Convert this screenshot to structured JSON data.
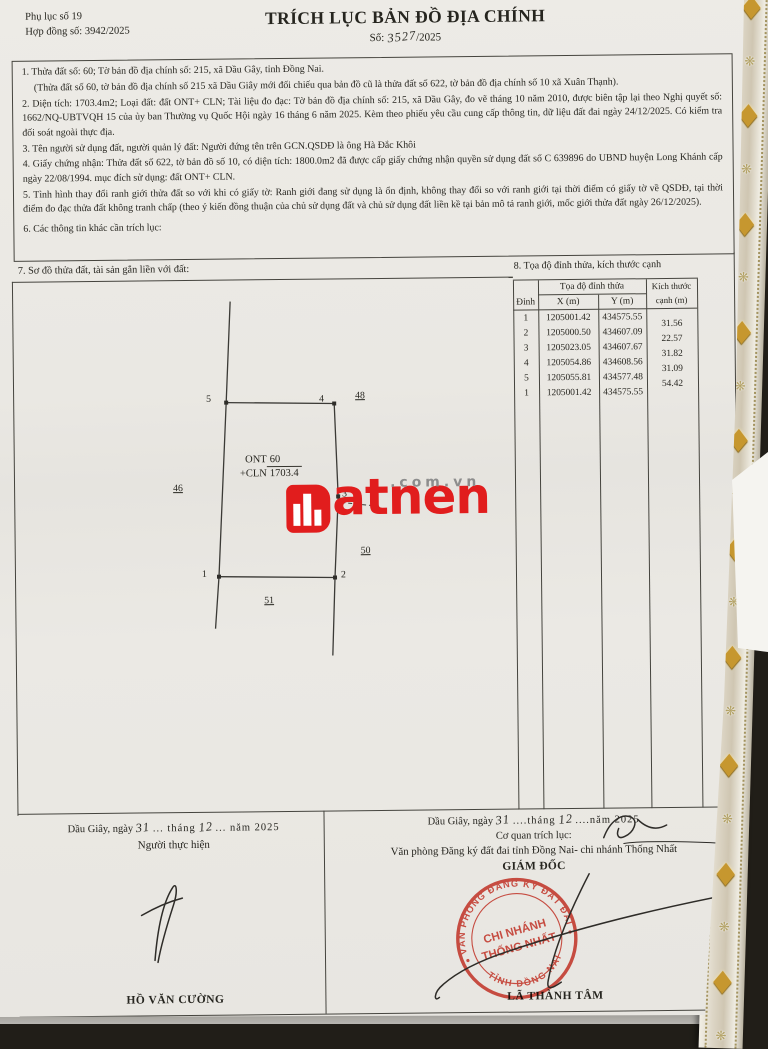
{
  "doc": {
    "appendix": "Phụ lục số 19",
    "contract_no": "Hợp đồng số: 3942/2025",
    "title": "TRÍCH LỤC BẢN ĐỒ ĐỊA CHÍNH",
    "number_prefix": "Số:",
    "number_handwritten": "3527",
    "number_suffix": "/2025"
  },
  "items": {
    "item1": "1. Thửa đất số: 60; Tờ bản đồ địa chính số: 215, xã Dầu Gây, tỉnh Đồng Nai.",
    "item1_note": "(Thửa đất số 60, tờ bản đồ địa chính số 215 xã Dầu Giây mới đối chiếu qua bản đồ cũ là thửa đất số 622, tờ bản đồ địa chính số 10 xã Xuân Thạnh).",
    "item2": "2. Diện tích: 1703.4m2; Loại đất: đất ONT+ CLN; Tài liệu đo đạc: Tờ bản đồ địa chính số: 215, xã Dầu Gây, đo vẽ tháng 10 năm 2010, được biên tập lại theo Nghị quyết số: 1662/NQ-UBTVQH 15 của ủy ban Thường vụ Quốc Hội ngày 16 tháng 6 năm 2025. Kèm theo phiếu yêu cầu cung cấp thông tin, dữ liệu đất đai ngày 24/12/2025. Có kiểm tra đối soát ngoài thực địa.",
    "item3": "3. Tên người sử dụng đất, người quản lý đất: Người đứng tên trên GCN.QSDĐ là ông Hà Đắc Khôi",
    "item4": "4. Giấy chứng nhận: Thửa đất số 622, tờ bản đồ số 10, có diện tích: 1800.0m2 đã được cấp giấy chứng nhận quyền sử dụng đất số C 639896 do UBND huyện Long Khánh cấp ngày 22/08/1994. mục đích sử dụng: đất ONT+ CLN.",
    "item5": "5. Tình hình thay đổi ranh giới thửa đất so với khi có giấy tờ: Ranh giới đang sử dụng là ổn định, không thay đổi so với ranh giới tại thời điểm có giấy tờ về QSDĐ, tại thời điểm đo đạc thửa đất không tranh chấp (theo ý kiến đồng thuận của chủ sử dụng đất và chủ sử dụng đất liền kề tại bản mô tả ranh giới, mốc giới thửa đất ngày 26/12/2025).",
    "item6": "6. Các thông tin khác cần trích lục:"
  },
  "section7": {
    "heading": "7. Sơ đồ thửa đất, tài sản gắn liền với đất:",
    "sketch": {
      "land_use_code1": "ONT",
      "land_use_code2": "+CLN",
      "parcel_number": "60",
      "parcel_area": "1703.4",
      "vertex1": "1",
      "vertex2": "2",
      "vertex3": "3",
      "vertex4": "4",
      "vertex5": "5",
      "neighbor_left": "46",
      "neighbor_top_right": "48",
      "neighbor_right": "50",
      "neighbor_bottom": "51"
    }
  },
  "section8": {
    "heading": "8. Tọa độ đỉnh thửa, kích thước cạnh",
    "table": {
      "group_header": "Tọa độ đỉnh thửa",
      "col_vertex": "Đỉnh",
      "col_x": "X (m)",
      "col_y": "Y (m)",
      "col_edge": "Kích thước cạnh (m)",
      "rows": [
        {
          "v": "1",
          "x": "1205001.42",
          "y": "434575.55"
        },
        {
          "v": "2",
          "x": "1205000.50",
          "y": "434607.09"
        },
        {
          "v": "3",
          "x": "1205023.05",
          "y": "434607.67"
        },
        {
          "v": "4",
          "x": "1205054.86",
          "y": "434608.56"
        },
        {
          "v": "5",
          "x": "1205055.81",
          "y": "434577.48"
        },
        {
          "v": "1",
          "x": "1205001.42",
          "y": "434575.55"
        }
      ],
      "edges": [
        "31.56",
        "22.57",
        "31.82",
        "31.09",
        "54.42"
      ]
    }
  },
  "watermark": {
    "brand_rest": "atnen",
    "domain": ".com.vn",
    "brand_color": "#e11d1d"
  },
  "footer": {
    "left": {
      "place": "Dầu Giây, ngày",
      "day": "31",
      "month_label": "... tháng",
      "month": "12",
      "year_label": "... năm 2025",
      "role": "Người thực hiện",
      "name": "HỒ VĂN CƯỜNG"
    },
    "right": {
      "place": "Dầu Giây, ngày",
      "day": "31",
      "month_label": "....tháng",
      "month": "12",
      "year_label": "....năm 2025",
      "agency_label": "Cơ quan trích lục:",
      "office": "Văn phòng Đăng ký đất đai tỉnh Đồng Nai- chi nhánh Thống Nhất",
      "role": "GIÁM ĐỐC",
      "name": "LÃ THÀNH TÂM"
    }
  },
  "stamp": {
    "ring_top": "VĂN PHÒNG ĐĂNG KÝ ĐẤT ĐAI",
    "ring_bottom": "TỈNH ĐỒNG NAI",
    "center_line1": "CHI NHÁNH",
    "center_line2": "THỐNG NHẤT",
    "color": "#c23a2f"
  },
  "frame": {
    "ornament_pairs": 10
  }
}
